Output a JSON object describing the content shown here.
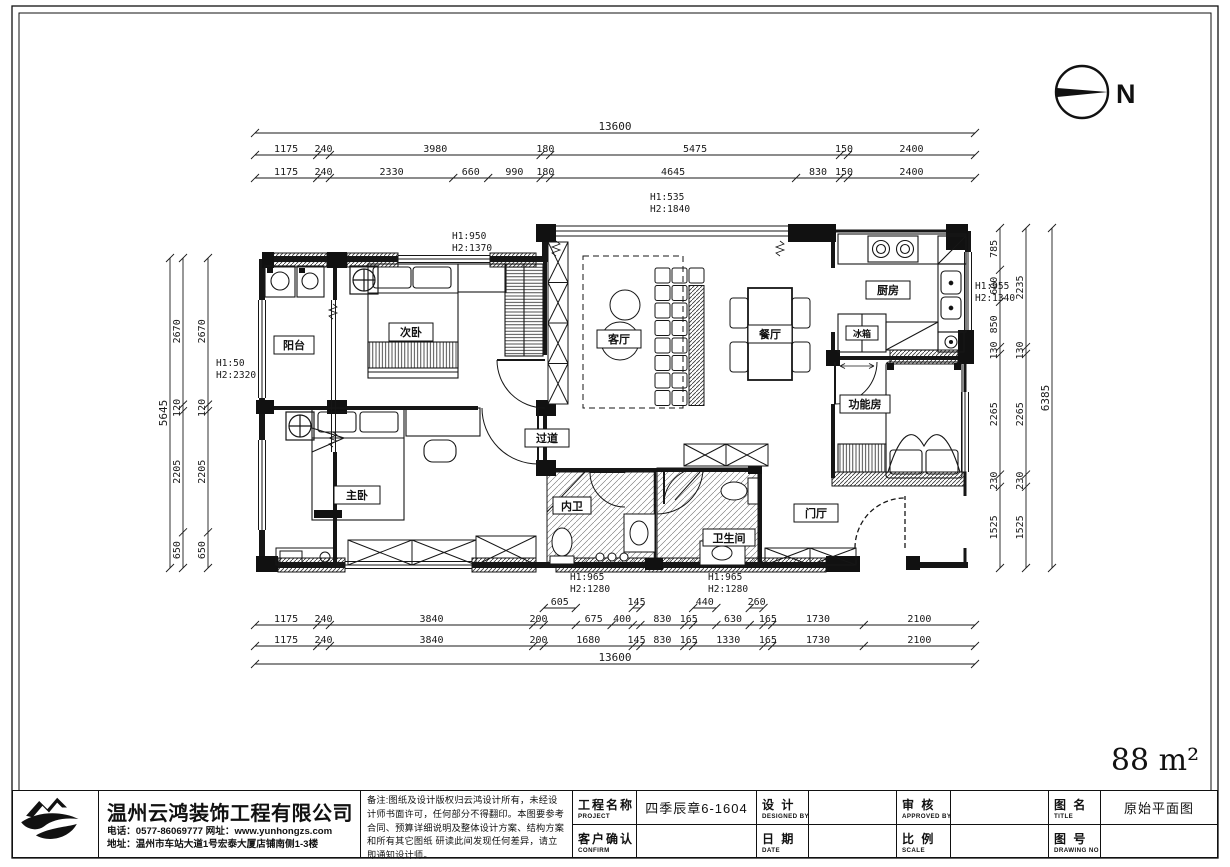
{
  "page": {
    "area_label": "88 m²",
    "north_label": "N"
  },
  "rooms": {
    "balcony": "阳台",
    "bedroom2": "次卧",
    "living": "客厅",
    "dining": "餐厅",
    "kitchen": "厨房",
    "fridge": "冰箱",
    "function_room": "功能房",
    "master": "主卧",
    "corridor": "过道",
    "inner_bath": "内卫",
    "bathroom": "卫生间",
    "foyer": "门厅"
  },
  "height_notes": {
    "top_window": {
      "l1": "H1:535",
      "l2": "H2:1840"
    },
    "bedroom2_window": {
      "l1": "H1:950",
      "l2": "H2:1370"
    },
    "balcony_window": {
      "l1": "H1:50",
      "l2": "H2:2320"
    },
    "kitchen_window": {
      "l1": "H1:955",
      "l2": "H2:1340"
    },
    "bath_window_left": {
      "l1": "H1:965",
      "l2": "H2:1280"
    },
    "bath_window_right": {
      "l1": "H1:965",
      "l2": "H2:1280"
    }
  },
  "dims": {
    "top_total": 13600,
    "top_row1": [
      1175,
      240,
      3980,
      180,
      5475,
      150,
      2400
    ],
    "top_row2": [
      1175,
      240,
      2330,
      660,
      990,
      180,
      4645,
      830,
      150,
      2400
    ],
    "bottom_partial": [
      605,
      145,
      440,
      260
    ],
    "bottom_row1": [
      1175,
      240,
      3840,
      200,
      675,
      400,
      830,
      165,
      630,
      165,
      1730,
      2100
    ],
    "bottom_row2": [
      1175,
      240,
      3840,
      200,
      1680,
      145,
      830,
      165,
      1330,
      165,
      1730,
      2100
    ],
    "bottom_total": 13600,
    "left_total": 5645,
    "left_col": [
      2670,
      120,
      2205,
      650
    ],
    "right_col1": [
      785,
      600,
      850,
      130,
      2265,
      230,
      1525
    ],
    "right_col2": [
      2235,
      130,
      2265,
      230,
      1525
    ],
    "right_total": 6385
  },
  "titleblock": {
    "company_name": "温州云鸿装饰工程有限公司",
    "contact_line1": "电话：0577-86069777  网址：www.yunhongzs.com",
    "contact_line2": "地址：温州市车站大道1号宏泰大厦店铺南侧1-3楼",
    "notes": "备注:图纸及设计版权归云鸿设计所有，未经设计师书面许可，任何部分不得翻印。本图要参考合同、预算详细说明及整体设计方案、结构方案和所有其它图纸 研读此间发现任何差异，请立即通知设计师。",
    "project_label_cn": "工程名称",
    "project_label_en": "PROJECT",
    "project_value": "四季辰章6-1604",
    "confirm_label_cn": "客户确认",
    "confirm_label_en": "CONFIRM",
    "confirm_value": "",
    "design_label_cn": "设  计",
    "design_label_en": "DESIGNED BY",
    "design_value": "",
    "date_label_cn": "日  期",
    "date_label_en": "DATE",
    "date_value": "",
    "approve_label_cn": "审  核",
    "approve_label_en": "APPROVED BY",
    "approve_value": "",
    "scale_label_cn": "比  例",
    "scale_label_en": "SCALE",
    "scale_value": "",
    "title_label_cn": "图  名",
    "title_label_en": "TITLE",
    "title_value": "原始平面图",
    "no_label_cn": "图  号",
    "no_label_en": "DRAWING NO",
    "no_value": ""
  }
}
